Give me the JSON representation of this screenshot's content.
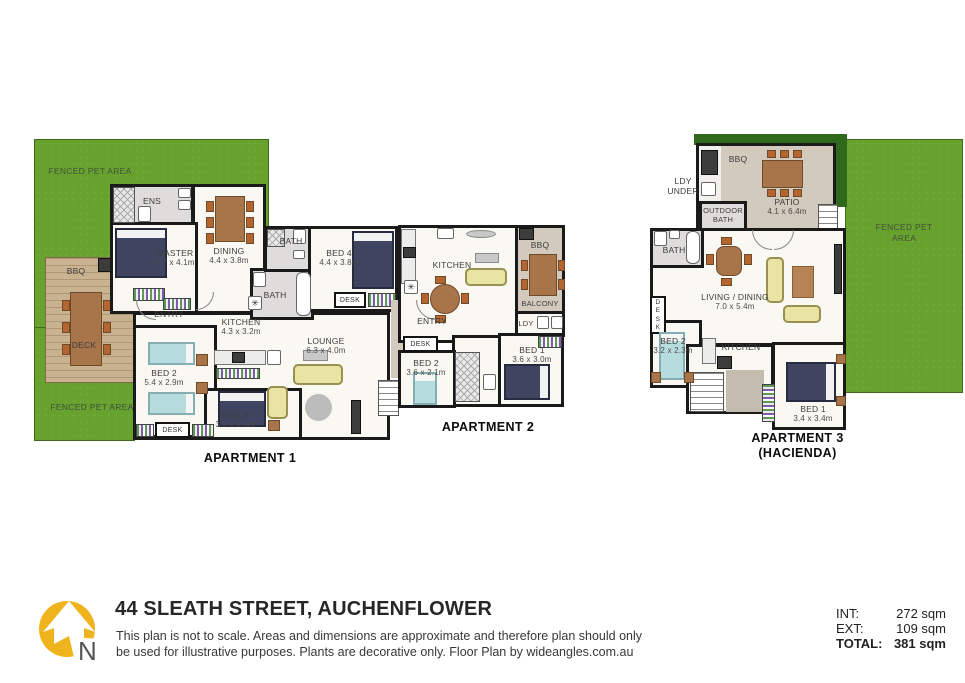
{
  "apt1": {
    "label": "APARTMENT 1",
    "fenced_pet_top": "FENCED PET AREA",
    "fenced_pet_bottom": "FENCED PET AREA",
    "bbq": "BBQ",
    "deck": "DECK",
    "ens": "ENS",
    "master": {
      "name": "MASTER",
      "dim": "3.7 x 4.1m"
    },
    "dining": {
      "name": "DINING",
      "dim": "4.4 x 3.8m"
    },
    "bath_top": "BATH",
    "bath_bottom": "BATH",
    "bed4": {
      "name": "BED 4",
      "dim": "4.4 x 3.8m"
    },
    "desk_bed4": "DESK",
    "entry": "ENTRY",
    "kitchen": {
      "name": "KITCHEN",
      "dim": "4.3 x 3.2m"
    },
    "lounge": {
      "name": "LOUNGE",
      "dim": "6.3 x 4.0m"
    },
    "bed2": {
      "name": "BED 2",
      "dim": "5.4 x 2.9m"
    },
    "bed3": {
      "name": "BED 3",
      "dim": "3.5 x 3.5m"
    },
    "desk_bed2": "DESK"
  },
  "apt2": {
    "label": "APARTMENT 2",
    "kitchen": "KITCHEN",
    "bbq": "BBQ",
    "balcony": "BALCONY",
    "ldy": "LDY",
    "entry": "ENTRY",
    "desk": "DESK",
    "bed2": {
      "name": "BED 2",
      "dim": "3.6 x 2.1m"
    },
    "bed1": {
      "name": "BED 1",
      "dim": "3.6 x 3.0m"
    }
  },
  "apt3": {
    "label": "APARTMENT 3",
    "sublabel": "(HACIENDA)",
    "bbq": "BBQ",
    "ldy_under": "LDY UNDER",
    "outdoor_bath": "OUTDOOR BATH",
    "patio": {
      "name": "PATIO",
      "dim": "4.1 x 6.4m"
    },
    "fenced_pet": "FENCED PET AREA",
    "bath": "BATH",
    "desk": "DESK",
    "living": {
      "name": "LIVING / DINING",
      "dim": "7.0 x 5.4m"
    },
    "bed2": {
      "name": "BED 2",
      "dim": "3.2 x 2.3m"
    },
    "kitchen": "KITCHEN",
    "bed1": {
      "name": "BED 1",
      "dim": "3.4 x 3.4m"
    }
  },
  "footer": {
    "title": "44 SLEATH STREET, AUCHENFLOWER",
    "disclaimer_line1": "This plan is not to scale. Areas and dimensions are approximate and therefore plan should only",
    "disclaimer_line2": "be used for illustrative purposes. Plants are decorative only. Floor Plan by wideangles.com.au",
    "compass": "N",
    "areas": {
      "int_label": "INT:",
      "int_value": "272 sqm",
      "ext_label": "EXT:",
      "ext_value": "109 sqm",
      "total_label": "TOTAL:",
      "total_value": "381 sqm"
    }
  },
  "icons": {
    "appliance": "✳"
  },
  "colors": {
    "grass": "#67a22f",
    "hedge": "#30681c",
    "deck_wood": "#c9b28f",
    "patio_floor": "#d2cabc",
    "wall": "#1a1a1a",
    "logo_yellow": "#efb31d"
  }
}
